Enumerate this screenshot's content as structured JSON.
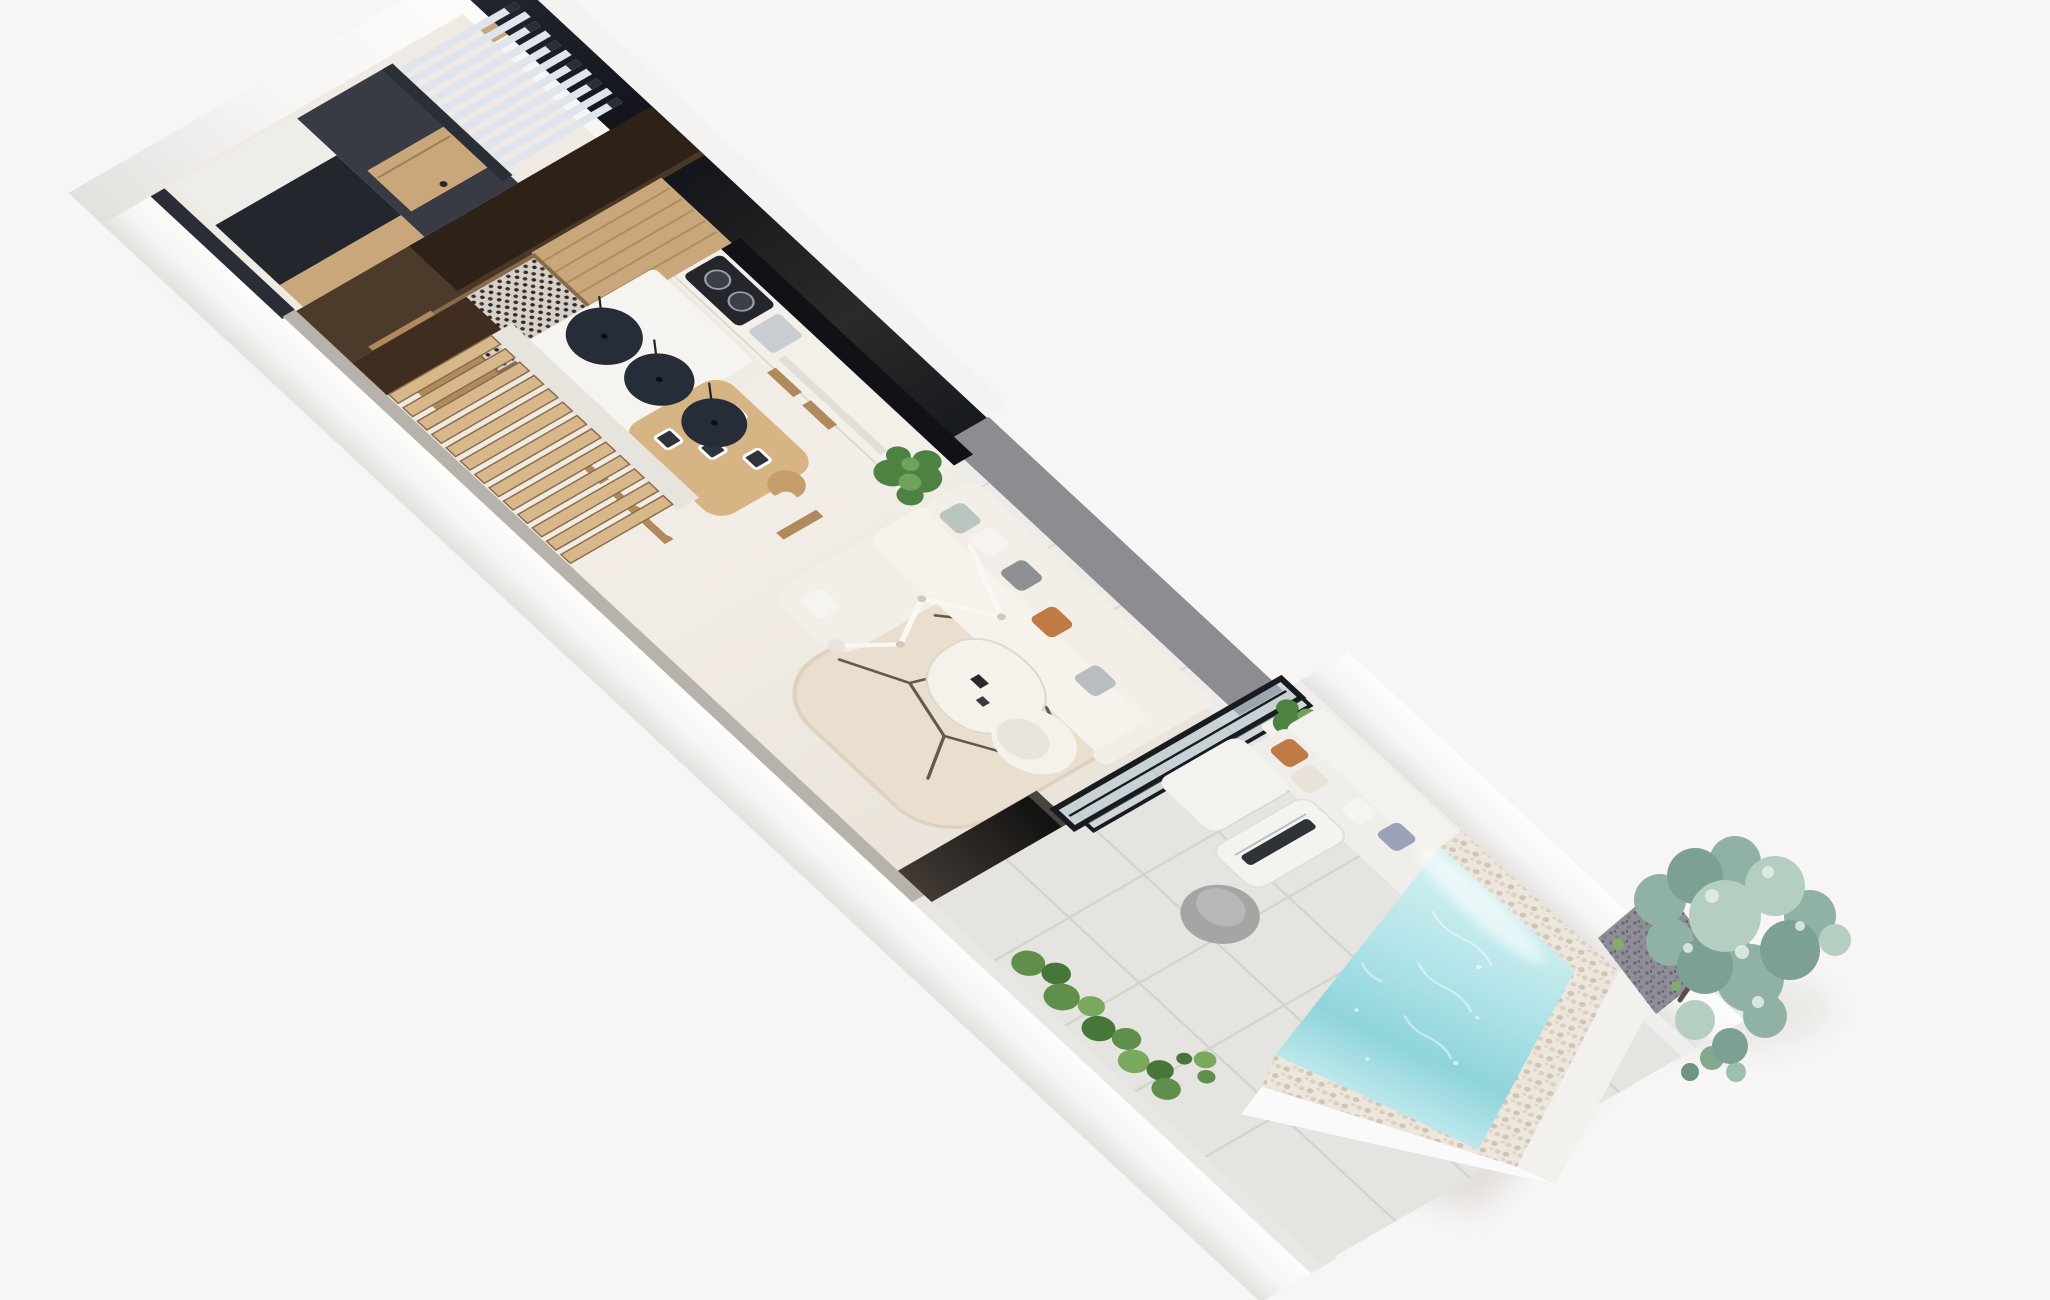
{
  "scene": {
    "type": "3d-floor-plan-render",
    "view": "isometric-top-down-cutaway",
    "background": "#f8f6f5"
  },
  "palette": {
    "bg": "#f8f6f5",
    "wall_white": "#fbfbfa",
    "wall_shade": "#e9e7e4",
    "wall_greige_top": "#b7b2ac",
    "cut_dark": "#16181e",
    "cut_dark2": "#32363f",
    "cut_gray": "#8d8c90",
    "espresso": "#2e2117",
    "walnut_floor": "#4c3a2b",
    "wood": "#c9a77b",
    "wood_dark": "#b08a5c",
    "floor_cream": "#efeae3",
    "tile_gray": "#e6e4e0",
    "counter_white": "#f3f0ea",
    "backsplash": "#101216",
    "cooktop_dark": "#24262b",
    "steel": "#c9ccd0",
    "island_white": "#f6f4f0",
    "table_wood": "#d7b484",
    "chair_seat": "#f1ede6",
    "pendant_navy": "#262c38",
    "stair_wood": "#d8b78a",
    "stair_landing": "#3f2d1f",
    "wine_rack_bg": "#d6d0c8",
    "pergola_slat": "#dfe5ec",
    "rug": "#eadfce",
    "rug_line": "#3f3a33",
    "sofa": "#f3efe8",
    "lounge": "#f5f2ec",
    "glass": "#aabfcc",
    "frame_dark": "#181b20",
    "bench_white": "#f4f2ee",
    "pouf_gray": "#a6a5a3",
    "hedge_green": "#5f8f4a",
    "monstera": "#4e8243",
    "pool_light": "#cdeef0",
    "pool_deep": "#8fd6dd",
    "pebble": "#ece6dd",
    "gravel": "#8f8d96",
    "tree_green": "#8fb2a4",
    "tree_green_light": "#b4cfc2",
    "tree_green_dark": "#7da094",
    "pillow_orange": "#bf7a45",
    "pillow_gray": "#8e9094",
    "pillow_blue": "#9aa2b8",
    "pillow_white": "#f6f4f0"
  },
  "inventory": {
    "rooms": [
      "entry",
      "wardrobe-hall",
      "kitchen",
      "dining",
      "staircase",
      "living-room",
      "terrace",
      "pool-deck"
    ],
    "counts": {
      "pendant_lamps": 3,
      "dining_chairs": 6,
      "pergola_slats": 11,
      "stair_treads": 13
    },
    "objects": [
      "pergola",
      "wood-door",
      "wine-rack",
      "kitchen-island",
      "cooktop",
      "dining-table",
      "staircase",
      "sofa",
      "coffee-table",
      "floor-lamp",
      "lounge-chair",
      "rug",
      "tv-cabinet",
      "glass-sliding-door",
      "monstera-plant",
      "outdoor-bench",
      "fire-table",
      "pouf",
      "hedge",
      "swimming-pool",
      "pebble-border",
      "garden-tree",
      "gravel-patch"
    ]
  }
}
